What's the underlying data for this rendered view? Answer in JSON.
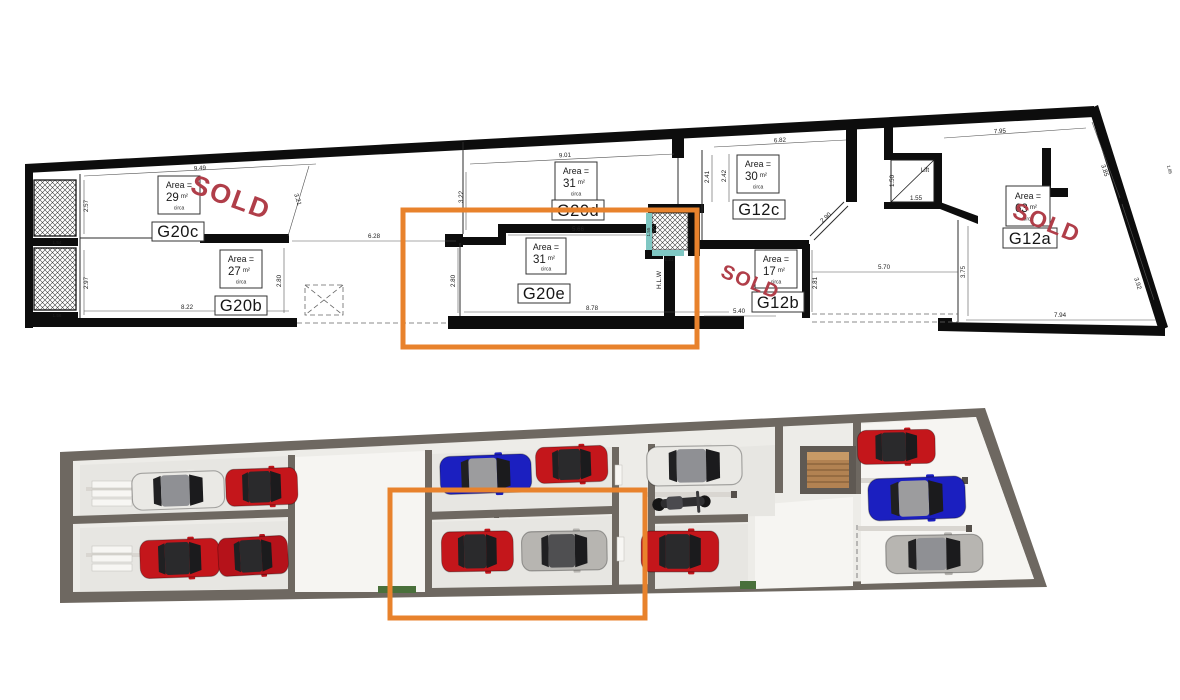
{
  "colors": {
    "highlight": "#E8822C",
    "sold": "#B03E49",
    "teal": "#7FC7C3",
    "plan_wall": "#0D0D0D",
    "render_wall": "#6E6861"
  },
  "plan": {
    "sold_label": "SOLD",
    "lift_label": "Lift",
    "shaft_label": "H.L.W",
    "area_label": "Area =",
    "area_note": "circa",
    "rooms": [
      {
        "label": "G20c",
        "area": "29",
        "unit": "m²",
        "sold": true
      },
      {
        "label": "G20b",
        "area": "27",
        "unit": "m²",
        "sold": false
      },
      {
        "label": "G20d",
        "area": "31",
        "unit": "m²",
        "sold": false
      },
      {
        "label": "G20e",
        "area": "31",
        "unit": "m²",
        "sold": false,
        "highlighted": true
      },
      {
        "label": "G12c",
        "area": "30",
        "unit": "m²",
        "sold": false
      },
      {
        "label": "G12b",
        "area": "17",
        "unit": "m²",
        "sold": true
      },
      {
        "label": "G12a",
        "area": "63",
        "unit": "m²",
        "sold": true
      }
    ],
    "dims": {
      "g20c_top": "9.49",
      "g20c_left": "2.57",
      "g20c_diag": "3.21",
      "shaft1_w": "1.54",
      "g20b_left": "2.97",
      "g20b_bottom": "8.22",
      "g20b_right": "2.80",
      "shaft2_w": "1.56",
      "drive_top": "6.28",
      "g20d_top": "9.01",
      "g20d_left": "3.22",
      "g20d_r1": "2.41",
      "g20d_r2": "2.42",
      "g20e_top": "5.66",
      "g20e_left": "2.80",
      "g20e_bottom": "8.78",
      "hlw_h": "1.55",
      "hlw_w": "1.21",
      "g12c_top": "6.82",
      "g12c_diag": "2.90",
      "lift_h": "1.50",
      "lift_w": "1.55",
      "court_w": "5.70",
      "g12b_bottom": "5.40",
      "g12b_right": "2.81",
      "g12a_top": "7.95",
      "g12a_r1": "3.85",
      "g12a_edge": "1.85",
      "g12a_r2": "3.92",
      "g12a_bottom": "7.94",
      "g12a_left": "3.75"
    }
  },
  "render": {
    "bays": [
      {
        "unit": "G20c",
        "vehicles": [
          "white car",
          "red car"
        ]
      },
      {
        "unit": "G20b",
        "vehicles": [
          "red car",
          "red car"
        ]
      },
      {
        "unit": "G20d",
        "vehicles": [
          "blue car",
          "red car"
        ]
      },
      {
        "unit": "G20e",
        "vehicles": [
          "red car",
          "silver car"
        ],
        "highlighted": true
      },
      {
        "unit": "G12c",
        "vehicles": [
          "white car",
          "motorcycle"
        ]
      },
      {
        "unit": "G12b",
        "vehicles": [
          "red car"
        ]
      },
      {
        "unit": "G12a",
        "vehicles": [
          "red car",
          "blue car",
          "silver car"
        ]
      }
    ],
    "core": {
      "staircase": true
    }
  }
}
